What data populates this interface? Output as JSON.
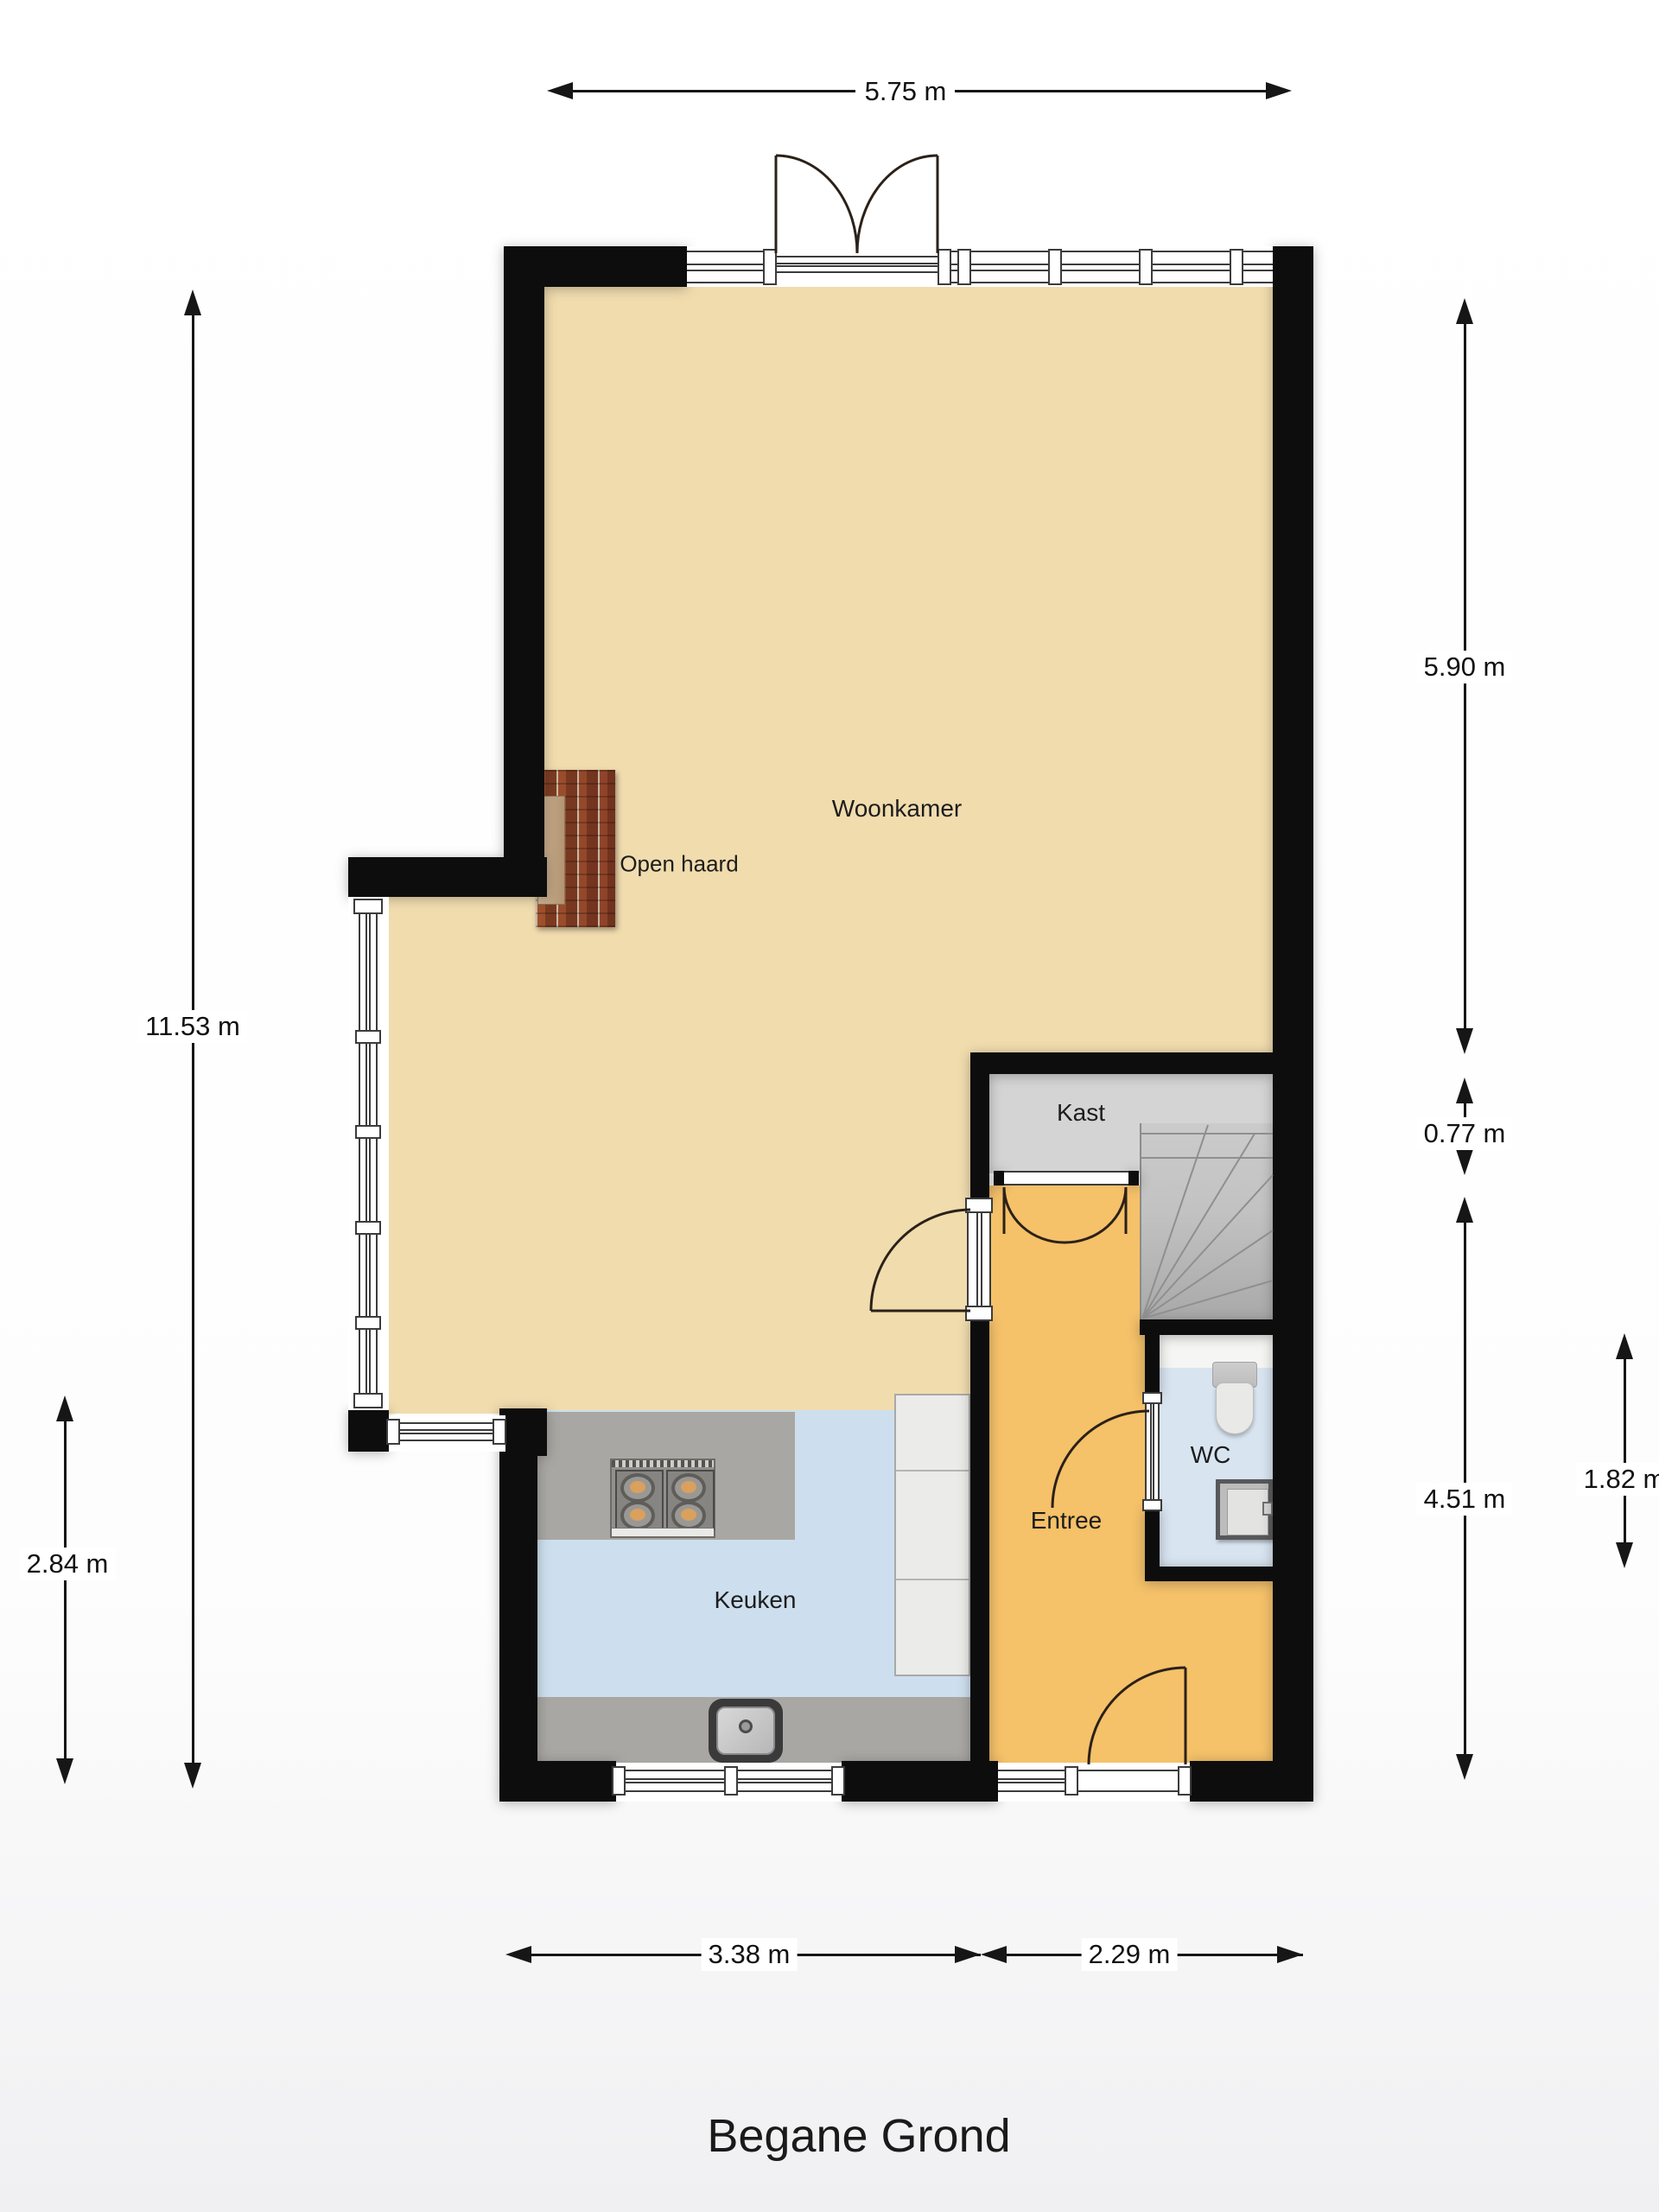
{
  "title": "Begane Grond",
  "rooms": {
    "woonkamer": "Woonkamer",
    "keuken": "Keuken",
    "entree": "Entree",
    "wc": "WC",
    "kast": "Kast"
  },
  "annotations": {
    "open_haard": "Open haard"
  },
  "dimensions": {
    "top_width": "5.75 m",
    "left_total": "11.53 m",
    "left_kitchen": "2.84 m",
    "right_woonkamer": "5.90 m",
    "right_kast": "0.77 m",
    "right_entree": "4.51 m",
    "right_wc": "1.82 m",
    "bottom_keuken": "3.38 m",
    "bottom_entree": "2.29 m"
  },
  "colors": {
    "wall": "#0d0d0d",
    "woonkamer_floor": "#f1dcae",
    "keuken_floor": "#cddfee",
    "entree_floor": "#f5c169",
    "wc_floor": "#d8e4f0",
    "kast_floor": "#d4d4d4",
    "stairs": "#bdbdbd",
    "counter": "#a9a7a3",
    "cabinet": "#ebebe9",
    "brick": "#94462f"
  }
}
